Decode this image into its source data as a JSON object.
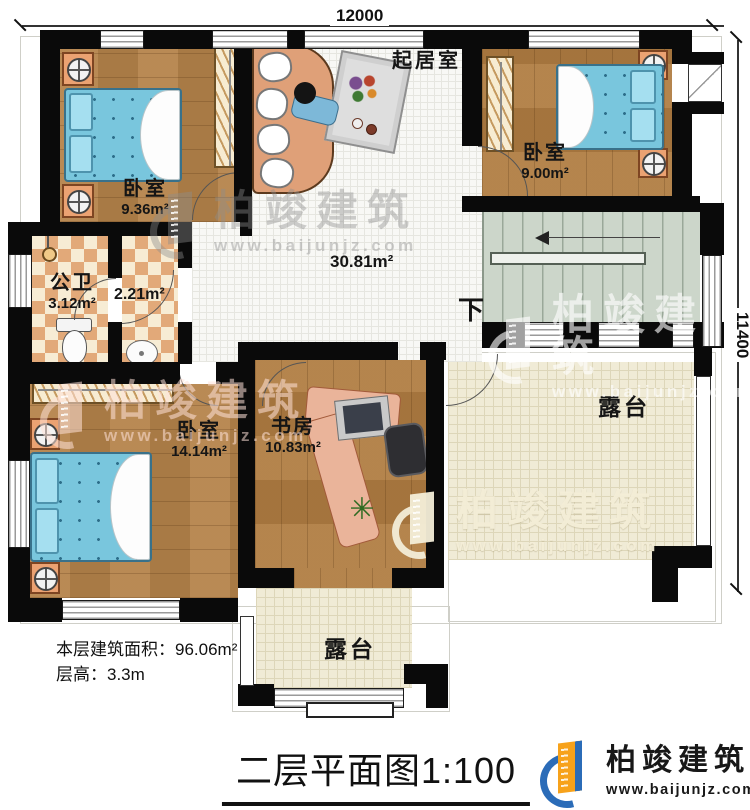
{
  "title": "二层平面图1:100",
  "dimensions": {
    "width_top": "12000",
    "height_right": "11400"
  },
  "rooms": {
    "living": {
      "name": "起居室",
      "area": "30.81m²"
    },
    "bedroom_top_left": {
      "name": "卧室",
      "area": "9.36m²"
    },
    "bedroom_top_right": {
      "name": "卧室",
      "area": "9.00m²"
    },
    "bathroom": {
      "name": "公卫",
      "area": "3.12m²"
    },
    "closet": {
      "area": "2.21m²"
    },
    "bedroom_bottom_left": {
      "name": "卧室",
      "area": "14.14m²"
    },
    "study": {
      "name": "书房",
      "area": "10.83m²"
    },
    "terrace_right": {
      "name": "露台"
    },
    "terrace_bottom": {
      "name": "露台"
    },
    "stairs": {
      "down_label": "下"
    }
  },
  "stats": {
    "floor_area_label": "本层建筑面积：96.06m²",
    "floor_height_label": "层高：3.3m"
  },
  "brand": {
    "name": "柏竣建筑",
    "website": "www.baijunjz.com"
  },
  "watermark": {
    "name": "柏竣建筑",
    "website": "www.baijunjz.com"
  },
  "colors": {
    "wall": "#0a0a0a",
    "wood": "#b5834a",
    "tile": "#f8f8f5",
    "checker_dark": "#e2a979",
    "stairs": "#ccd6ca",
    "terrace": "#f0ebd6",
    "bed": "#79c6dd",
    "brand_blue": "#2b6cb8",
    "brand_orange": "#f7a21b"
  }
}
